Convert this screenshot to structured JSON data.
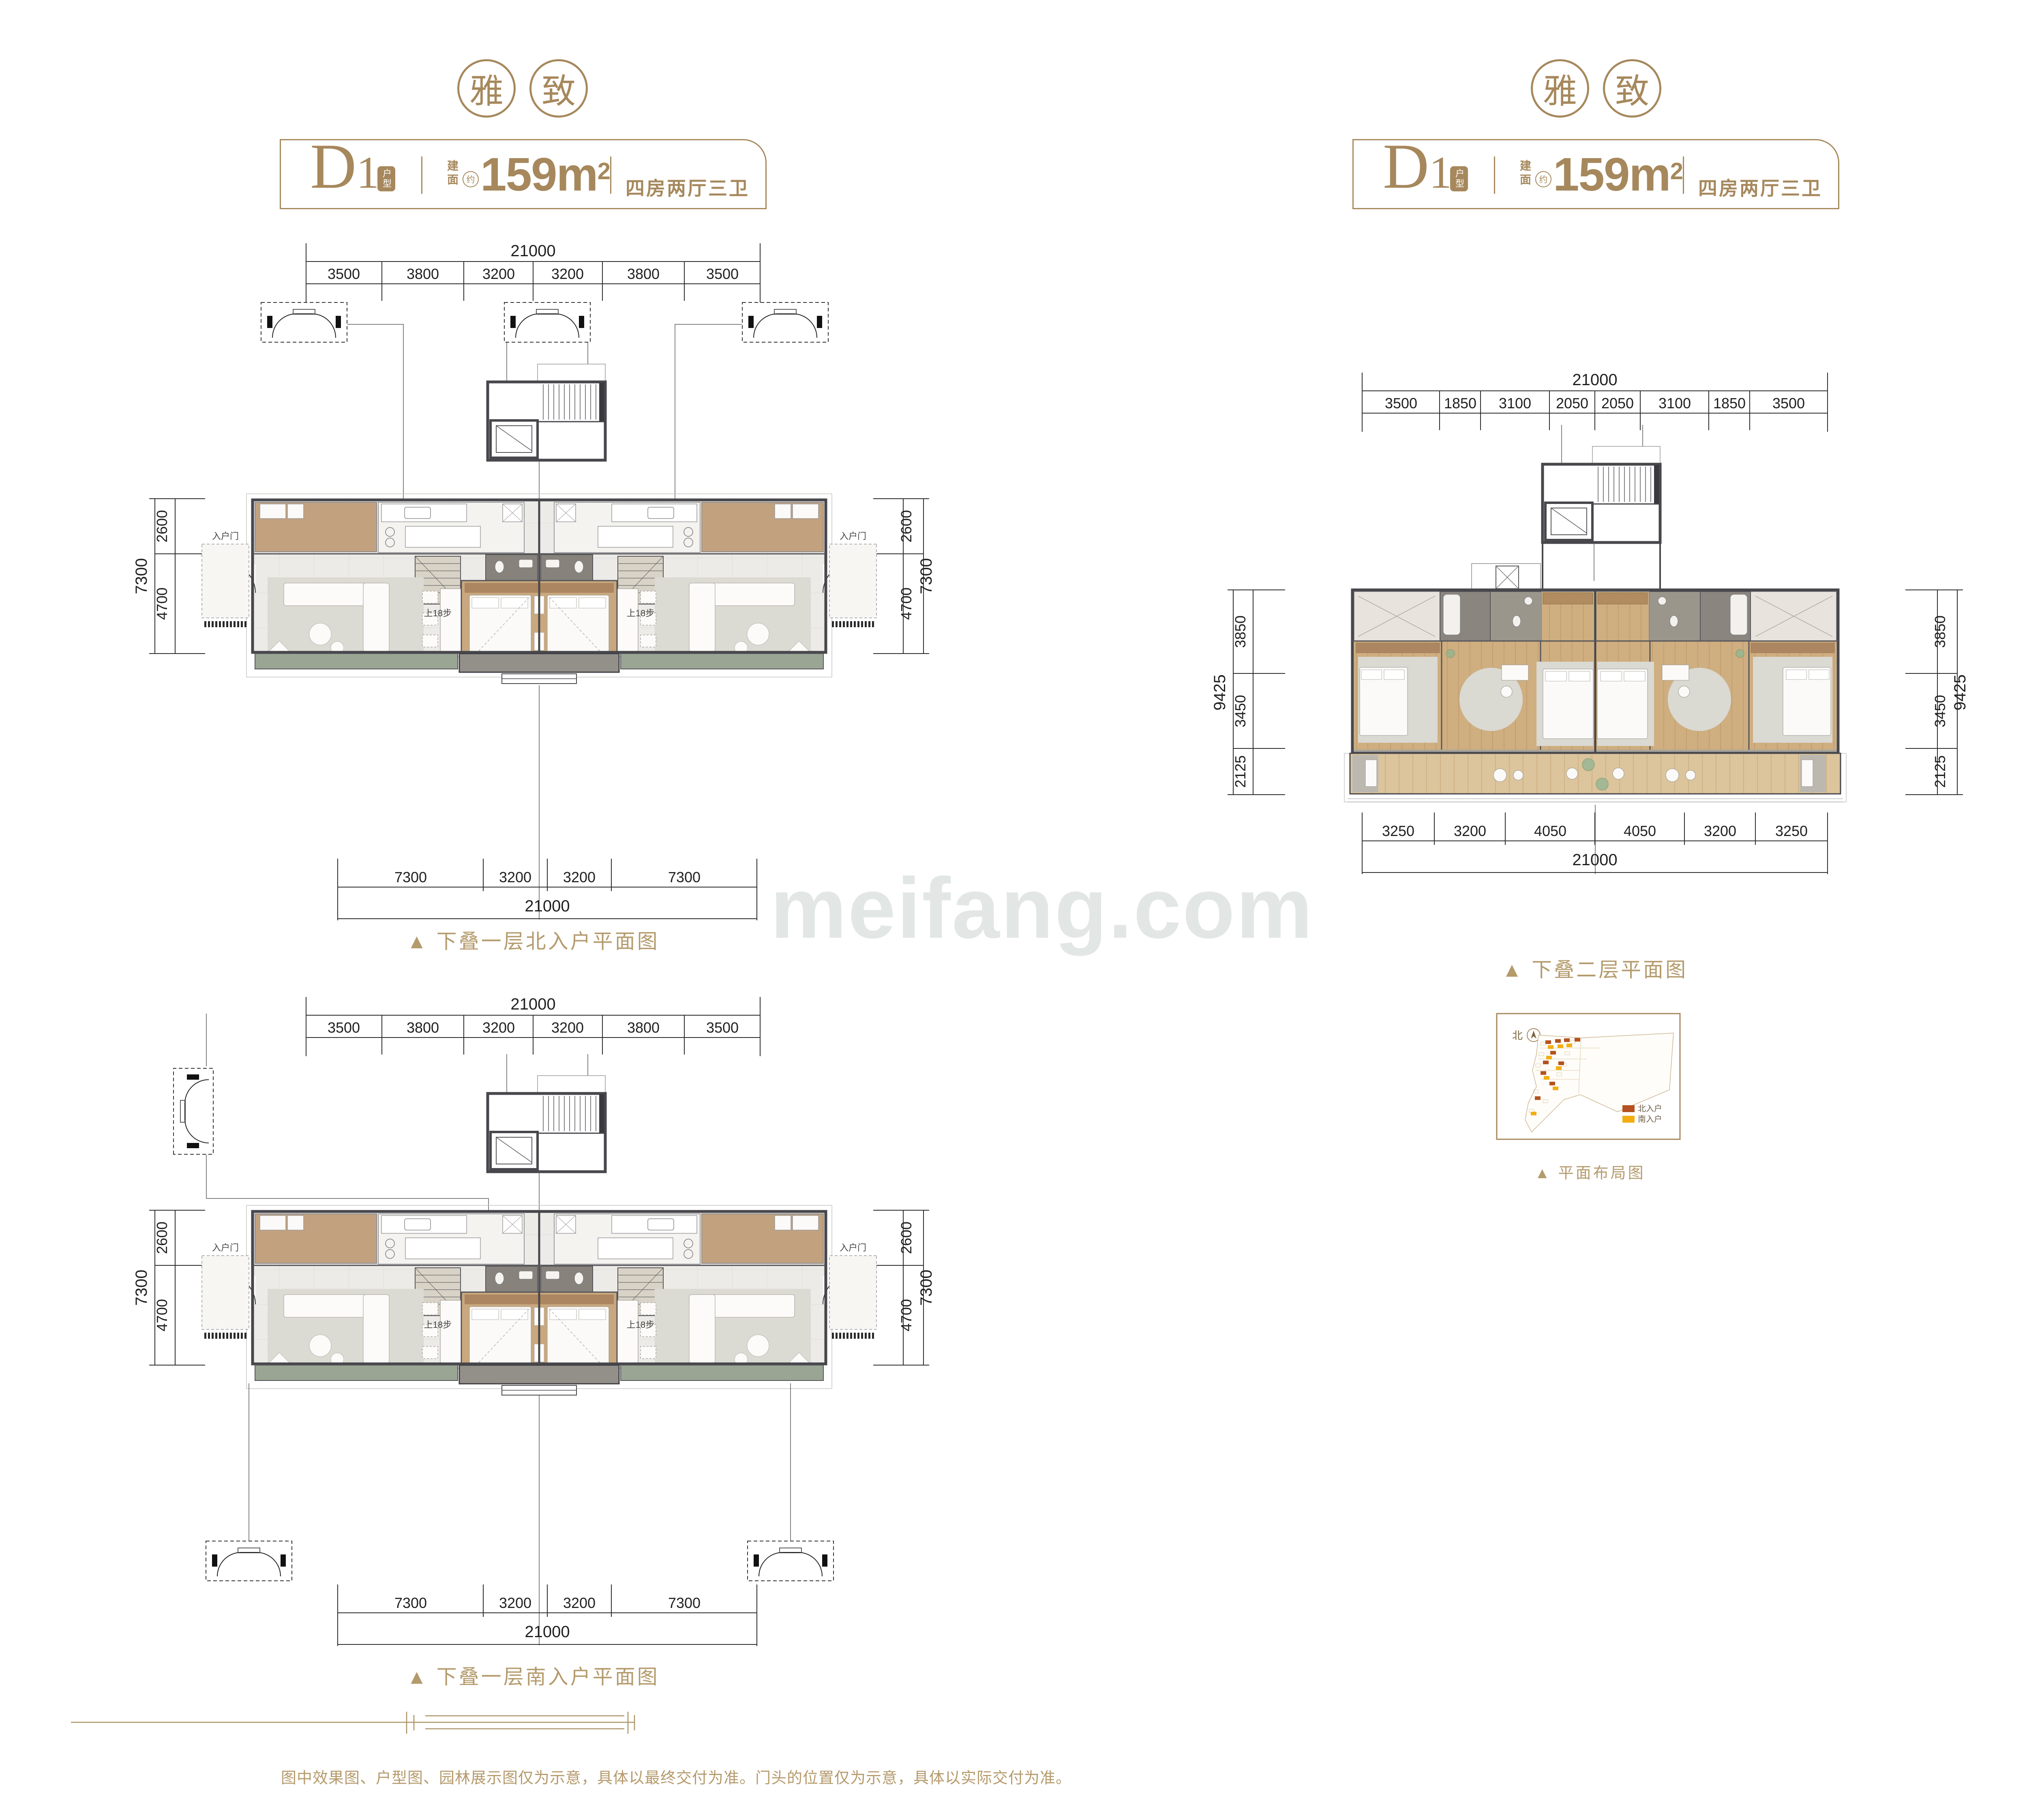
{
  "page": {
    "watermark": "meifang.com",
    "disclaimer": "图中效果图、户型图、园林展示图仅为示意，具体以最终交付为准。门头的位置仅为示意，具体以实际交付为准。"
  },
  "badge": {
    "left_char": "雅",
    "right_char": "致"
  },
  "header": {
    "code": "D",
    "code_num": "1",
    "code_tag": "户型",
    "area_label": "建面",
    "area_approx": "约",
    "area_value": "159m",
    "area_exp": "2",
    "rooms": "四房两厅三卫"
  },
  "annotations": {
    "entry_door": "入户门",
    "stair_steps": "上18步",
    "north": "北"
  },
  "plans": {
    "north_first": {
      "caption": "▲ 下叠一层北入户平面图",
      "top_total": "21000",
      "top_segments": [
        "3500",
        "3800",
        "3200",
        "3200",
        "3800",
        "3500"
      ],
      "side_total": "7300",
      "side_segments": [
        "2600",
        "4700"
      ],
      "bottom_total": "21000",
      "bottom_segments": [
        "7300",
        "3200",
        "3200",
        "7300"
      ]
    },
    "upper_second": {
      "caption": "▲ 下叠二层平面图",
      "top_total": "21000",
      "top_segments": [
        "3500",
        "1850",
        "3100",
        "2050",
        "2050",
        "3100",
        "1850",
        "3500"
      ],
      "side_total": "9425",
      "side_segments": [
        "3850",
        "3450",
        "2125"
      ],
      "bottom_total": "21000",
      "bottom_segments": [
        "3250",
        "3200",
        "4050",
        "4050",
        "3200",
        "3250"
      ]
    },
    "south_first": {
      "caption": "▲ 下叠一层南入户平面图",
      "top_total": "21000",
      "top_segments": [
        "3500",
        "3800",
        "3200",
        "3200",
        "3800",
        "3500"
      ],
      "side_total": "7300",
      "side_segments": [
        "2600",
        "4700"
      ],
      "bottom_total": "21000",
      "bottom_segments": [
        "7300",
        "3200",
        "3200",
        "7300"
      ]
    }
  },
  "siteplan": {
    "caption": "▲ 平面布局图",
    "legend": [
      {
        "label": "北入户",
        "color": "#b5521e"
      },
      {
        "label": "南入户",
        "color": "#f2ae13"
      }
    ]
  },
  "colors": {
    "gold": "#a6885c",
    "gold_light": "#b49b6d"
  }
}
